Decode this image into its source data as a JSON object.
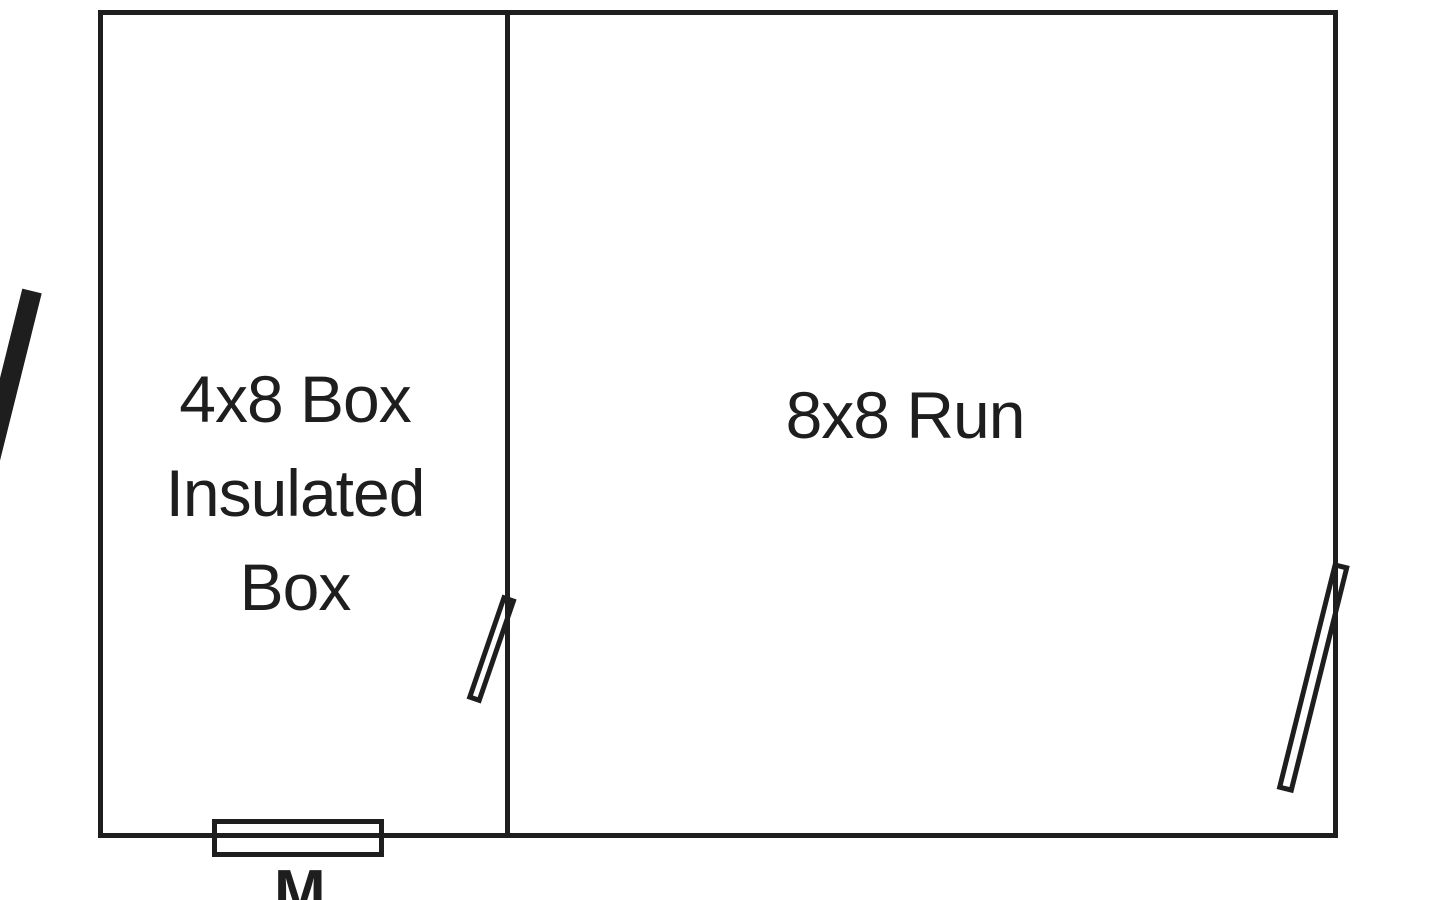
{
  "diagram": {
    "background_color": "#ffffff",
    "line_color": "#1e1e1e",
    "left_room": {
      "label_lines": [
        "4x8 Box",
        "Insulated",
        "Box"
      ]
    },
    "right_room": {
      "label": "8x8 Run"
    },
    "bottom_annotation": "M",
    "icons": {
      "left_door": "solid-open-door-icon",
      "middle_door": "outlined-swing-door-icon",
      "right_door": "outlined-swing-door-icon",
      "bottom_window": "wall-window-icon"
    }
  }
}
